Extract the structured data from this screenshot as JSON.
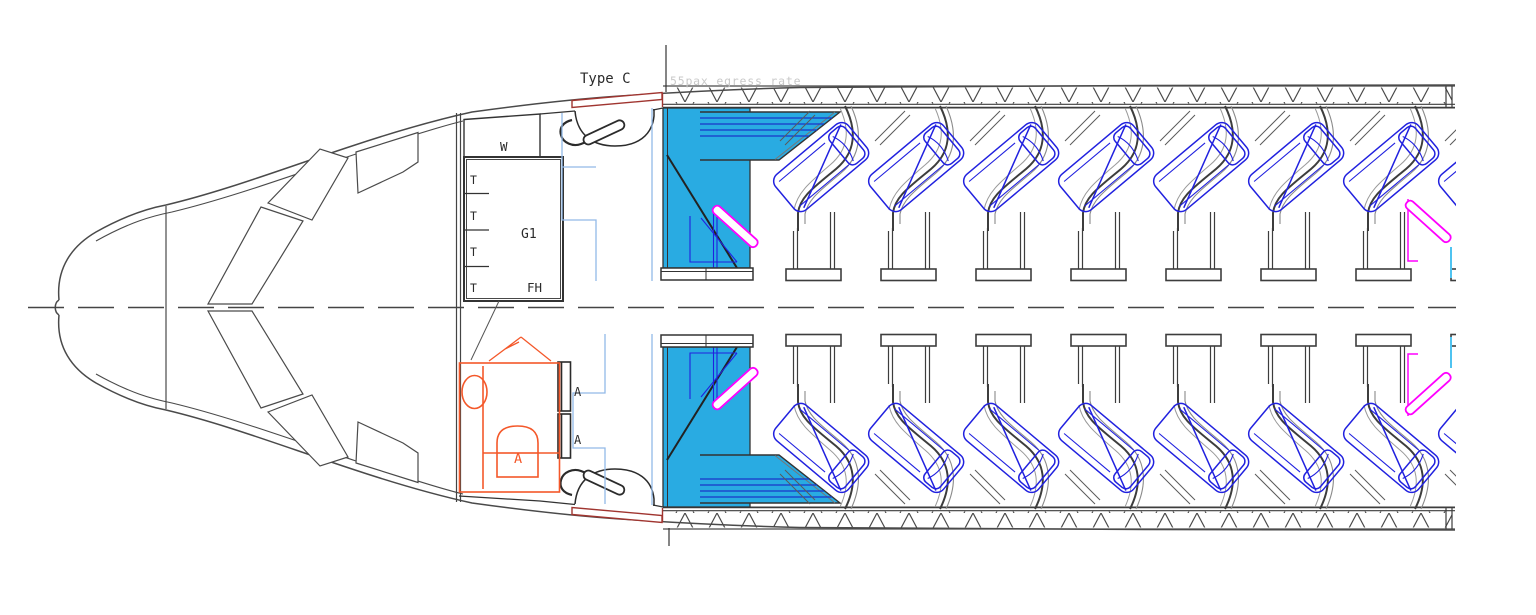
{
  "drawing": {
    "title": "Forward cabin layout of passenger aircraft (plan view CAD drawing)",
    "door": {
      "type_label": "Type C",
      "egress_label": "55pax egress rate"
    },
    "galley": {
      "wardrobe_label": "W",
      "name_label": "G1",
      "fh_label": "FH",
      "trolley_labels": [
        "T",
        "T",
        "T",
        "T"
      ]
    },
    "lavatory": {
      "label": "A"
    },
    "attendant_seats": {
      "labels": [
        "A",
        "A"
      ]
    },
    "cabin": {
      "layout": "reverse-herringbone business class",
      "rows": 2,
      "full_seats_per_row": 7,
      "partial_seats_per_row": 1,
      "seat_pitch_px": 95
    },
    "colors": {
      "monument_fill": "#29ABE2",
      "seat_line": "#2121DF",
      "console_stripe": "#1A35C9",
      "partition_magenta": "#FF00FF",
      "lavatory_orange": "#F4582A",
      "door_red": "#A03530",
      "clearance_blue": "#92B9E8",
      "egress_text_gray": "#C9C9C9",
      "linework": "#4A4A4A",
      "shell_dark": "#3D3D3D",
      "cyan_tick": "#4FC3F0"
    }
  }
}
